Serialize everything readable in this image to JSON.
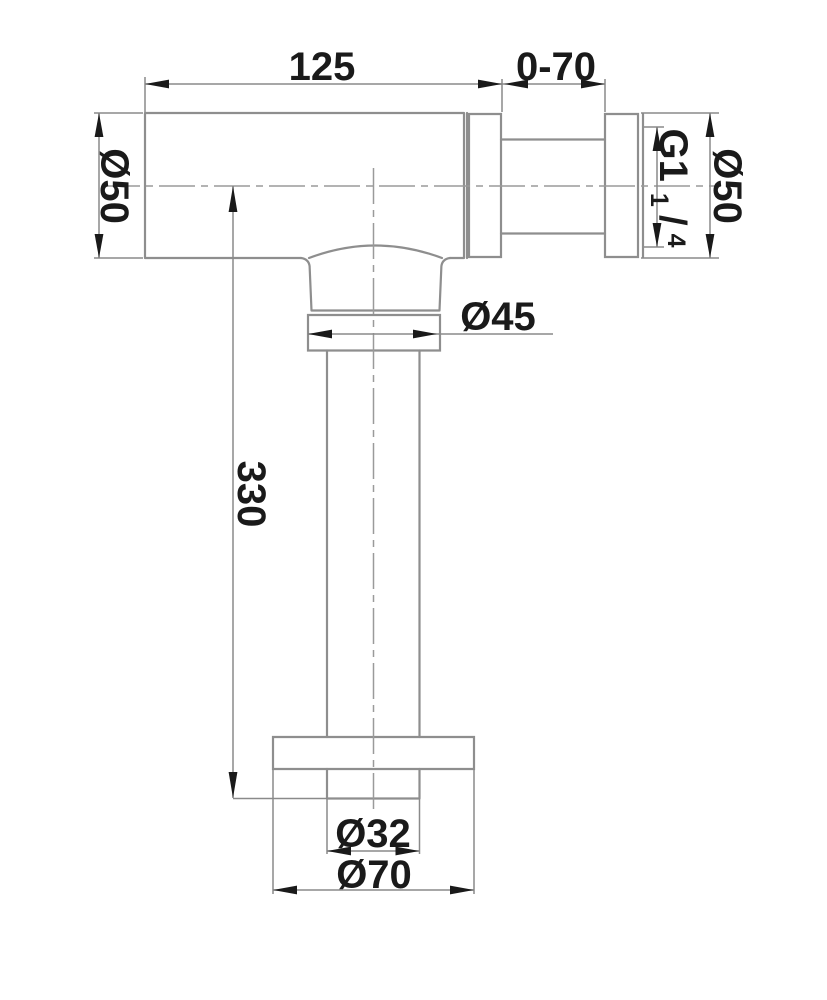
{
  "drawing": {
    "kind": "technical-dimension-drawing",
    "part": "bottle-trap-drain-fitting",
    "dimensions": {
      "top_length": "125",
      "adjustable_length": "0-70",
      "body_diameter_left": "Ø50",
      "thread": {
        "prefix": "G1",
        "numerator": "1",
        "slash": "/",
        "denominator": "4"
      },
      "flange_diameter_right": "Ø50",
      "nut_diameter": "Ø45",
      "height": "330",
      "pipe_diameter": "Ø32",
      "base_flange_diameter": "Ø70"
    },
    "colors": {
      "outline": "#8e8e8e",
      "centerline": "#9a9a9a",
      "dimension_line": "#8a8a8a",
      "text": "#1a1a1a",
      "arrow": "#1a1a1a",
      "background": "#ffffff"
    }
  }
}
